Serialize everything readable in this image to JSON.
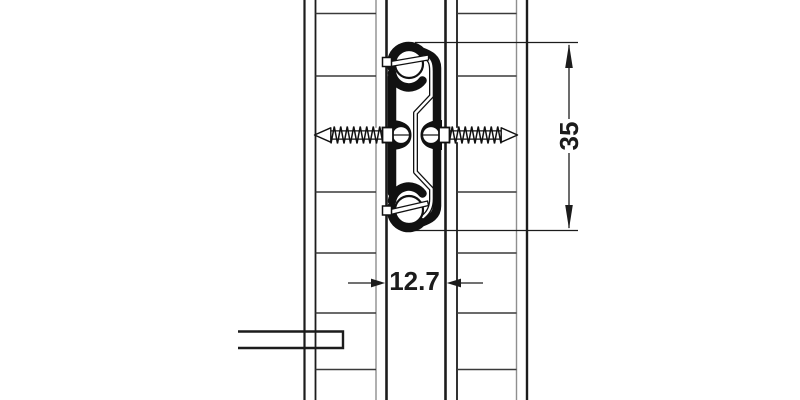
{
  "dimensions": {
    "vertical_label": "35",
    "horizontal_label": "12.7"
  },
  "colors": {
    "ink": "#1c1c1c",
    "secondary_line": "#8f8f8f",
    "background": "#ffffff"
  }
}
